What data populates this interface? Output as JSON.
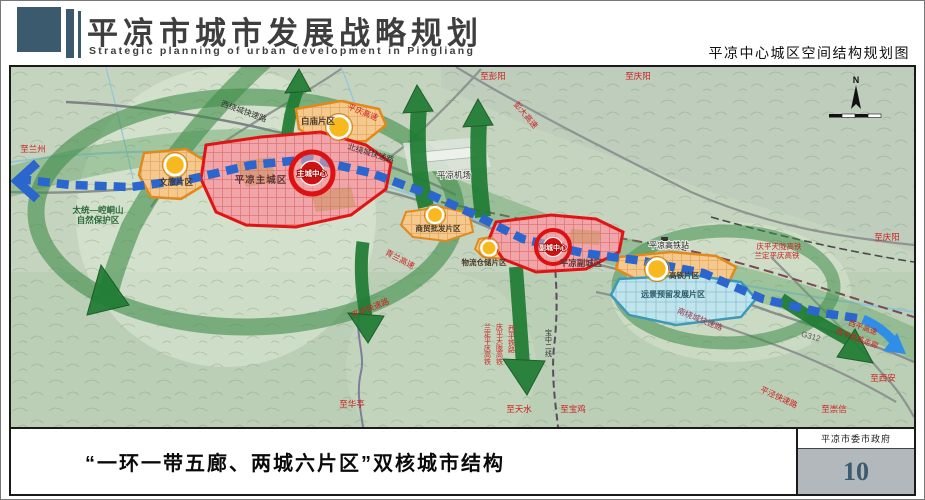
{
  "header": {
    "title": "平凉市城市发展战略规划",
    "subtitle": "Strategic planning of urban development in Pingliang",
    "caption": "平凉中心城区空间结构规划图"
  },
  "footer": {
    "caption": "“一环一带五廊、两城六片区”双核城市结构",
    "organization": "平凉市委市政府",
    "page_number": "10"
  },
  "map": {
    "compass_label": "N",
    "zones": {
      "main_city": "平凉主城区",
      "main_center": "主城中心",
      "sub_city": "平凉副城区",
      "sub_center": "副城中心",
      "baimiao": "白庙片区",
      "wenlv": "文旅片区",
      "shangmao": "商贸批发片区",
      "wuliu": "物流仓储片区",
      "gaotie": "高铁片区",
      "yuanjing": "远景预留发展片区"
    },
    "places": {
      "airport": "平凉机场",
      "hsr_station": "平凉高铁站",
      "nature_reserve_line1": "太统—崆峒山",
      "nature_reserve_line2": "自然保护区"
    },
    "roads": {
      "xiraocheng": "西绕城快速路",
      "beiraocheng": "北绕城快速路",
      "nanraocheng": "南绕城快速路",
      "pingqing": "平庆高速",
      "pengda": "彭大高速",
      "qinglan": "青兰高速",
      "pinghua": "平华快速路",
      "pingjing": "平泾快速路",
      "g312": "G312",
      "xiping_expwy": "西平高速",
      "xiping_rail": "西平铁路走廊",
      "hsr1": "庆平天陇高铁",
      "hsr2": "兰定平庆高铁",
      "v_hsr1": "兰定平庆高铁",
      "v_hsr2": "庆平天陇高铁",
      "v_rail1": "西平铁路",
      "v_rail2": "宝中二线"
    },
    "directions": {
      "lanzhou": "至兰州",
      "pengyang": "至彭阳",
      "qingyang_top": "至庆阳",
      "qingyang_right": "至庆阳",
      "xian": "至西安",
      "chongxin": "至崇信",
      "huating": "至华亭",
      "tianshui": "至天水",
      "baoji": "至宝鸡"
    },
    "colors": {
      "header_blue": "#3b5a6e",
      "zone_red_border": "#e01414",
      "zone_orange_border": "#e2891c",
      "axis_blue": "#2b66cf",
      "corridor_green": "#1f7c33",
      "reserve_cyan_border": "#3a9ab8",
      "page_number_bg": "#b2b8bc"
    }
  }
}
